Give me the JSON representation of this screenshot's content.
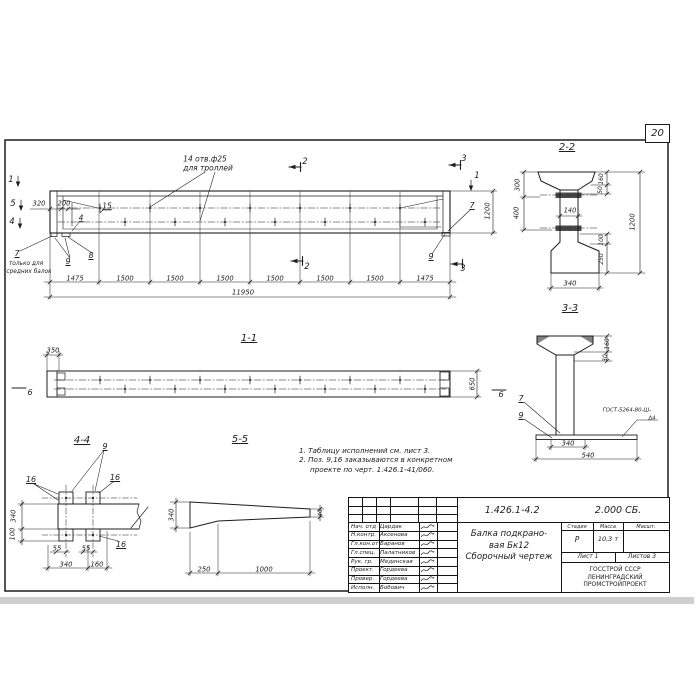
{
  "page": {
    "sheet_number": "20"
  },
  "colors": {
    "ink": "#1c1c1c",
    "paper": "#ffffff"
  },
  "drawing": {
    "doc_number": "1.426.1-4.2",
    "doc_suffix": "2.000 СБ.",
    "title_line1": "Балка подкрано-",
    "title_line2": "вая Бк12",
    "title_line3": "Сборочный чертеж",
    "stage_label": "Стадия",
    "mass_label": "Масса",
    "scale_label": "Масшт.",
    "stage_value": "Р",
    "mass_value": "10,3 т",
    "scale_value": "",
    "sheet_label": "Лист 1",
    "sheets_label": "Листов 3",
    "org_line1": "ГОССТРОЙ СССР",
    "org_line2": "ЛЕНИНГРАДСКИЙ",
    "org_line3": "ПРОМСТРОЙПРОЕКТ",
    "rows": [
      {
        "role": "Нач. отд",
        "name": "Цардак"
      },
      {
        "role": "Н.контр.",
        "name": "Аксенова"
      },
      {
        "role": "Гл.кон.от",
        "name": "Баранов"
      },
      {
        "role": "Гл.спец.",
        "name": "Палатников"
      },
      {
        "role": "Рук. гр.",
        "name": "Мединская"
      },
      {
        "role": "Проект.",
        "name": "Гордеева"
      },
      {
        "role": "Провер.",
        "name": "Гордеева"
      },
      {
        "role": "Исполн.",
        "name": "Бобович"
      }
    ]
  },
  "notes": [
    "1. Таблицу исполнений см. лист 3.",
    "2. Поз. 9,16 заказываются в конкретном",
    "проекте по черт. 1.426.1-41/060."
  ],
  "labels": [
    {
      "n": "holes-note-line1",
      "t": "14 отв.ф25",
      "x": 205,
      "y": 159,
      "s": 7.5
    },
    {
      "n": "holes-note-line2",
      "t": "для троллей",
      "x": 208,
      "y": 168,
      "s": 7.5
    },
    {
      "n": "cut-mark-2-top",
      "t": "2",
      "x": 305,
      "y": 162,
      "s": 8.5
    },
    {
      "n": "cut-mark-2-bottom",
      "t": "2",
      "x": 307,
      "y": 267,
      "s": 8.5
    },
    {
      "n": "cut-mark-3-top",
      "t": "3",
      "x": 464,
      "y": 159,
      "s": 8.5
    },
    {
      "n": "cut-mark-3-bottom",
      "t": "3",
      "x": 463,
      "y": 269,
      "s": 8.5
    },
    {
      "n": "cut-mark-1-right",
      "t": "1",
      "x": 477,
      "y": 176,
      "s": 8.5
    },
    {
      "n": "cut-mark-1-left",
      "t": "1",
      "x": 11,
      "y": 180,
      "s": 8.5
    },
    {
      "n": "cut-mark-5-left",
      "t": "5",
      "x": 13,
      "y": 204,
      "s": 8.5
    },
    {
      "n": "cut-mark-4-left",
      "t": "4",
      "x": 12,
      "y": 222,
      "s": 8.5
    },
    {
      "n": "dim",
      "t": "320",
      "x": 39,
      "y": 204,
      "s": 6.8
    },
    {
      "n": "dim",
      "t": "200",
      "x": 64,
      "y": 204,
      "s": 6.8
    },
    {
      "n": "pos-label",
      "t": "15",
      "u": true,
      "x": 107,
      "y": 206,
      "s": 7.5
    },
    {
      "n": "pos-label",
      "t": "4",
      "u": true,
      "x": 81,
      "y": 218,
      "s": 7.5
    },
    {
      "n": "pos-label",
      "t": "7",
      "u": true,
      "x": 17,
      "y": 254,
      "s": 8
    },
    {
      "n": "note-middle-beams-1",
      "t": "только для",
      "x": 26,
      "y": 265,
      "s": 5.8
    },
    {
      "n": "note-middle-beams-2",
      "t": "средних балок",
      "x": 29,
      "y": 272.5,
      "s": 5.8
    },
    {
      "n": "pos-label",
      "t": "9",
      "u": true,
      "x": 68,
      "y": 262,
      "s": 8
    },
    {
      "n": "pos-label",
      "t": "8",
      "u": true,
      "x": 91,
      "y": 256,
      "s": 8
    },
    {
      "n": "dim",
      "t": "1475",
      "x": 75,
      "y": 279,
      "s": 6.8
    },
    {
      "n": "dim",
      "t": "1500",
      "x": 125,
      "y": 279,
      "s": 6.8
    },
    {
      "n": "dim",
      "t": "1500",
      "x": 175,
      "y": 279,
      "s": 6.8
    },
    {
      "n": "dim",
      "t": "1500",
      "x": 225,
      "y": 279,
      "s": 6.8
    },
    {
      "n": "dim",
      "t": "1500",
      "x": 275,
      "y": 279,
      "s": 6.8
    },
    {
      "n": "dim",
      "t": "1500",
      "x": 325,
      "y": 279,
      "s": 6.8
    },
    {
      "n": "dim",
      "t": "1500",
      "x": 375,
      "y": 279,
      "s": 6.8
    },
    {
      "n": "dim",
      "t": "1475",
      "x": 425,
      "y": 279,
      "s": 6.8
    },
    {
      "n": "dim-total",
      "t": "11950",
      "x": 243,
      "y": 293,
      "s": 7
    },
    {
      "n": "dim",
      "t": "1200",
      "r": -90,
      "x": 488,
      "y": 211,
      "s": 6.8
    },
    {
      "n": "pos-label",
      "t": "7",
      "u": true,
      "x": 472,
      "y": 206,
      "s": 8
    },
    {
      "n": "pos-label",
      "t": "9",
      "u": true,
      "x": 431,
      "y": 257,
      "s": 8
    },
    {
      "n": "section-title",
      "t": "2-2",
      "u": true,
      "x": 567,
      "y": 148,
      "s": 10
    },
    {
      "n": "dim",
      "t": "300",
      "r": -90,
      "x": 518,
      "y": 185,
      "s": 6.6
    },
    {
      "n": "dim",
      "t": "400",
      "r": -90,
      "x": 517,
      "y": 213,
      "s": 6.6
    },
    {
      "n": "dim",
      "t": "140",
      "x": 570,
      "y": 211,
      "s": 6.6
    },
    {
      "n": "dim",
      "t": "160",
      "r": -90,
      "x": 602,
      "y": 179,
      "s": 6
    },
    {
      "n": "dim",
      "t": "50",
      "r": -90,
      "x": 601,
      "y": 190,
      "s": 6
    },
    {
      "n": "dim",
      "t": "1200",
      "r": -90,
      "x": 633,
      "y": 222,
      "s": 6.8
    },
    {
      "n": "dim",
      "t": "100",
      "r": -90,
      "x": 602,
      "y": 240,
      "s": 6
    },
    {
      "n": "dim",
      "t": "250",
      "r": -90,
      "x": 602,
      "y": 259,
      "s": 6
    },
    {
      "n": "dim",
      "t": "340",
      "x": 570,
      "y": 284,
      "s": 6.8
    },
    {
      "n": "section-title",
      "t": "3-3",
      "u": true,
      "x": 570,
      "y": 309,
      "s": 10
    },
    {
      "n": "dim",
      "t": "160",
      "r": -90,
      "x": 608,
      "y": 344,
      "s": 6
    },
    {
      "n": "dim",
      "t": "30",
      "r": -90,
      "x": 606,
      "y": 358,
      "s": 6
    },
    {
      "n": "pos-label",
      "t": "7",
      "u": true,
      "x": 521,
      "y": 399,
      "s": 8
    },
    {
      "n": "pos-label",
      "t": "9",
      "u": true,
      "x": 521,
      "y": 416,
      "s": 8
    },
    {
      "n": "weld-note-line1",
      "t": "ГОСТ-5264-80-Ш-",
      "x": 627,
      "y": 411,
      "s": 5.4
    },
    {
      "n": "weld-note-line2",
      "t": "Δ4",
      "x": 652,
      "y": 419,
      "s": 5.4
    },
    {
      "n": "dim",
      "t": "340",
      "x": 568,
      "y": 443.5,
      "s": 6.8
    },
    {
      "n": "dim",
      "t": "540",
      "x": 588,
      "y": 456,
      "s": 6.8
    },
    {
      "n": "section-title",
      "t": "1-1",
      "u": true,
      "x": 249,
      "y": 339,
      "s": 10
    },
    {
      "n": "dim",
      "t": "350",
      "x": 53,
      "y": 351,
      "s": 6.8
    },
    {
      "n": "dim",
      "t": "650",
      "r": -90,
      "x": 473,
      "y": 384,
      "s": 6.8
    },
    {
      "n": "section-marker",
      "t": "6",
      "x": 30,
      "y": 393,
      "s": 8
    },
    {
      "n": "section-marker",
      "t": "6",
      "x": 501,
      "y": 395,
      "s": 8
    },
    {
      "n": "section-title",
      "t": "4-4",
      "u": true,
      "x": 82,
      "y": 441,
      "s": 10
    },
    {
      "n": "pos-label",
      "t": "9",
      "u": true,
      "x": 105,
      "y": 447,
      "s": 8
    },
    {
      "n": "pos-label",
      "t": "16",
      "u": true,
      "x": 31,
      "y": 480,
      "s": 8
    },
    {
      "n": "pos-label",
      "t": "16",
      "u": true,
      "x": 115,
      "y": 478,
      "s": 8
    },
    {
      "n": "pos-label",
      "t": "16",
      "u": true,
      "x": 121,
      "y": 545,
      "s": 8
    },
    {
      "n": "dim",
      "t": "340",
      "r": -90,
      "x": 14,
      "y": 516,
      "s": 6.8
    },
    {
      "n": "dim",
      "t": "100",
      "r": -90,
      "x": 13,
      "y": 534,
      "s": 6.8
    },
    {
      "n": "dim",
      "t": "55",
      "x": 57,
      "y": 549,
      "s": 6.8
    },
    {
      "n": "dim",
      "t": "55",
      "x": 86,
      "y": 549,
      "s": 6.8
    },
    {
      "n": "dim",
      "t": "340",
      "x": 66,
      "y": 564.5,
      "s": 6.8
    },
    {
      "n": "dim",
      "t": "160",
      "x": 97,
      "y": 564.5,
      "s": 6.8
    },
    {
      "n": "section-title",
      "t": "5-5",
      "u": true,
      "x": 240,
      "y": 440,
      "s": 10
    },
    {
      "n": "dim",
      "t": "340",
      "r": -90,
      "x": 172,
      "y": 515,
      "s": 6.8
    },
    {
      "n": "dim",
      "t": "40",
      "r": -90,
      "x": 322,
      "y": 513,
      "s": 5.8
    },
    {
      "n": "dim",
      "t": "250",
      "x": 204,
      "y": 569.5,
      "s": 6.8
    },
    {
      "n": "dim",
      "t": "1000",
      "x": 264,
      "y": 569.5,
      "s": 6.8
    }
  ]
}
